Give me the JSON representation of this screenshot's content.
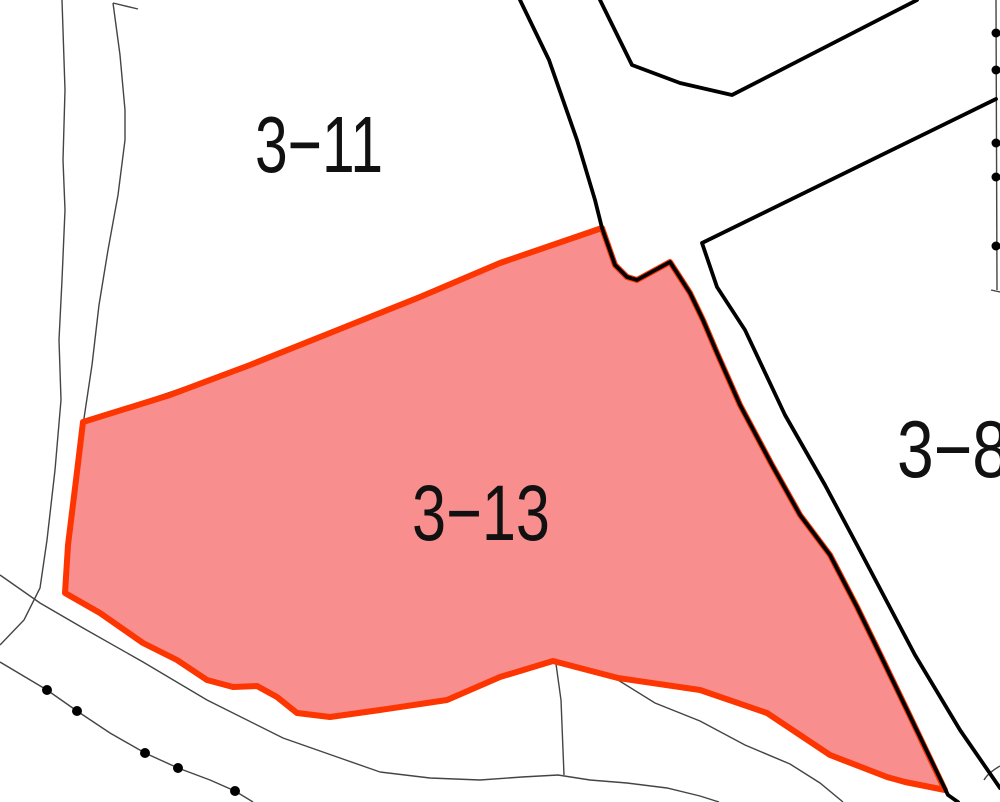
{
  "map": {
    "type": "cadastral-parcel-map",
    "background_color": "#ffffff",
    "theme": {
      "map_bg": "#ffffff",
      "thin_boundary_color": "#444444",
      "road_line_color": "#000000",
      "highlight_fill": "#F98E8E",
      "highlight_stroke": "#FD3500",
      "marker_color": "#000000",
      "label_color": "#111111"
    },
    "parcels": [
      {
        "id": "3-11",
        "label": "3−11",
        "highlighted": false
      },
      {
        "id": "3-13",
        "label": "3−13",
        "highlighted": true
      },
      {
        "id": "3-8",
        "label": "3−8",
        "highlighted": false
      }
    ],
    "highlighted_parcel": "3-13",
    "markers": {
      "right_edge_boundary_points": 5,
      "lower_left_boundary_points": 5
    }
  }
}
